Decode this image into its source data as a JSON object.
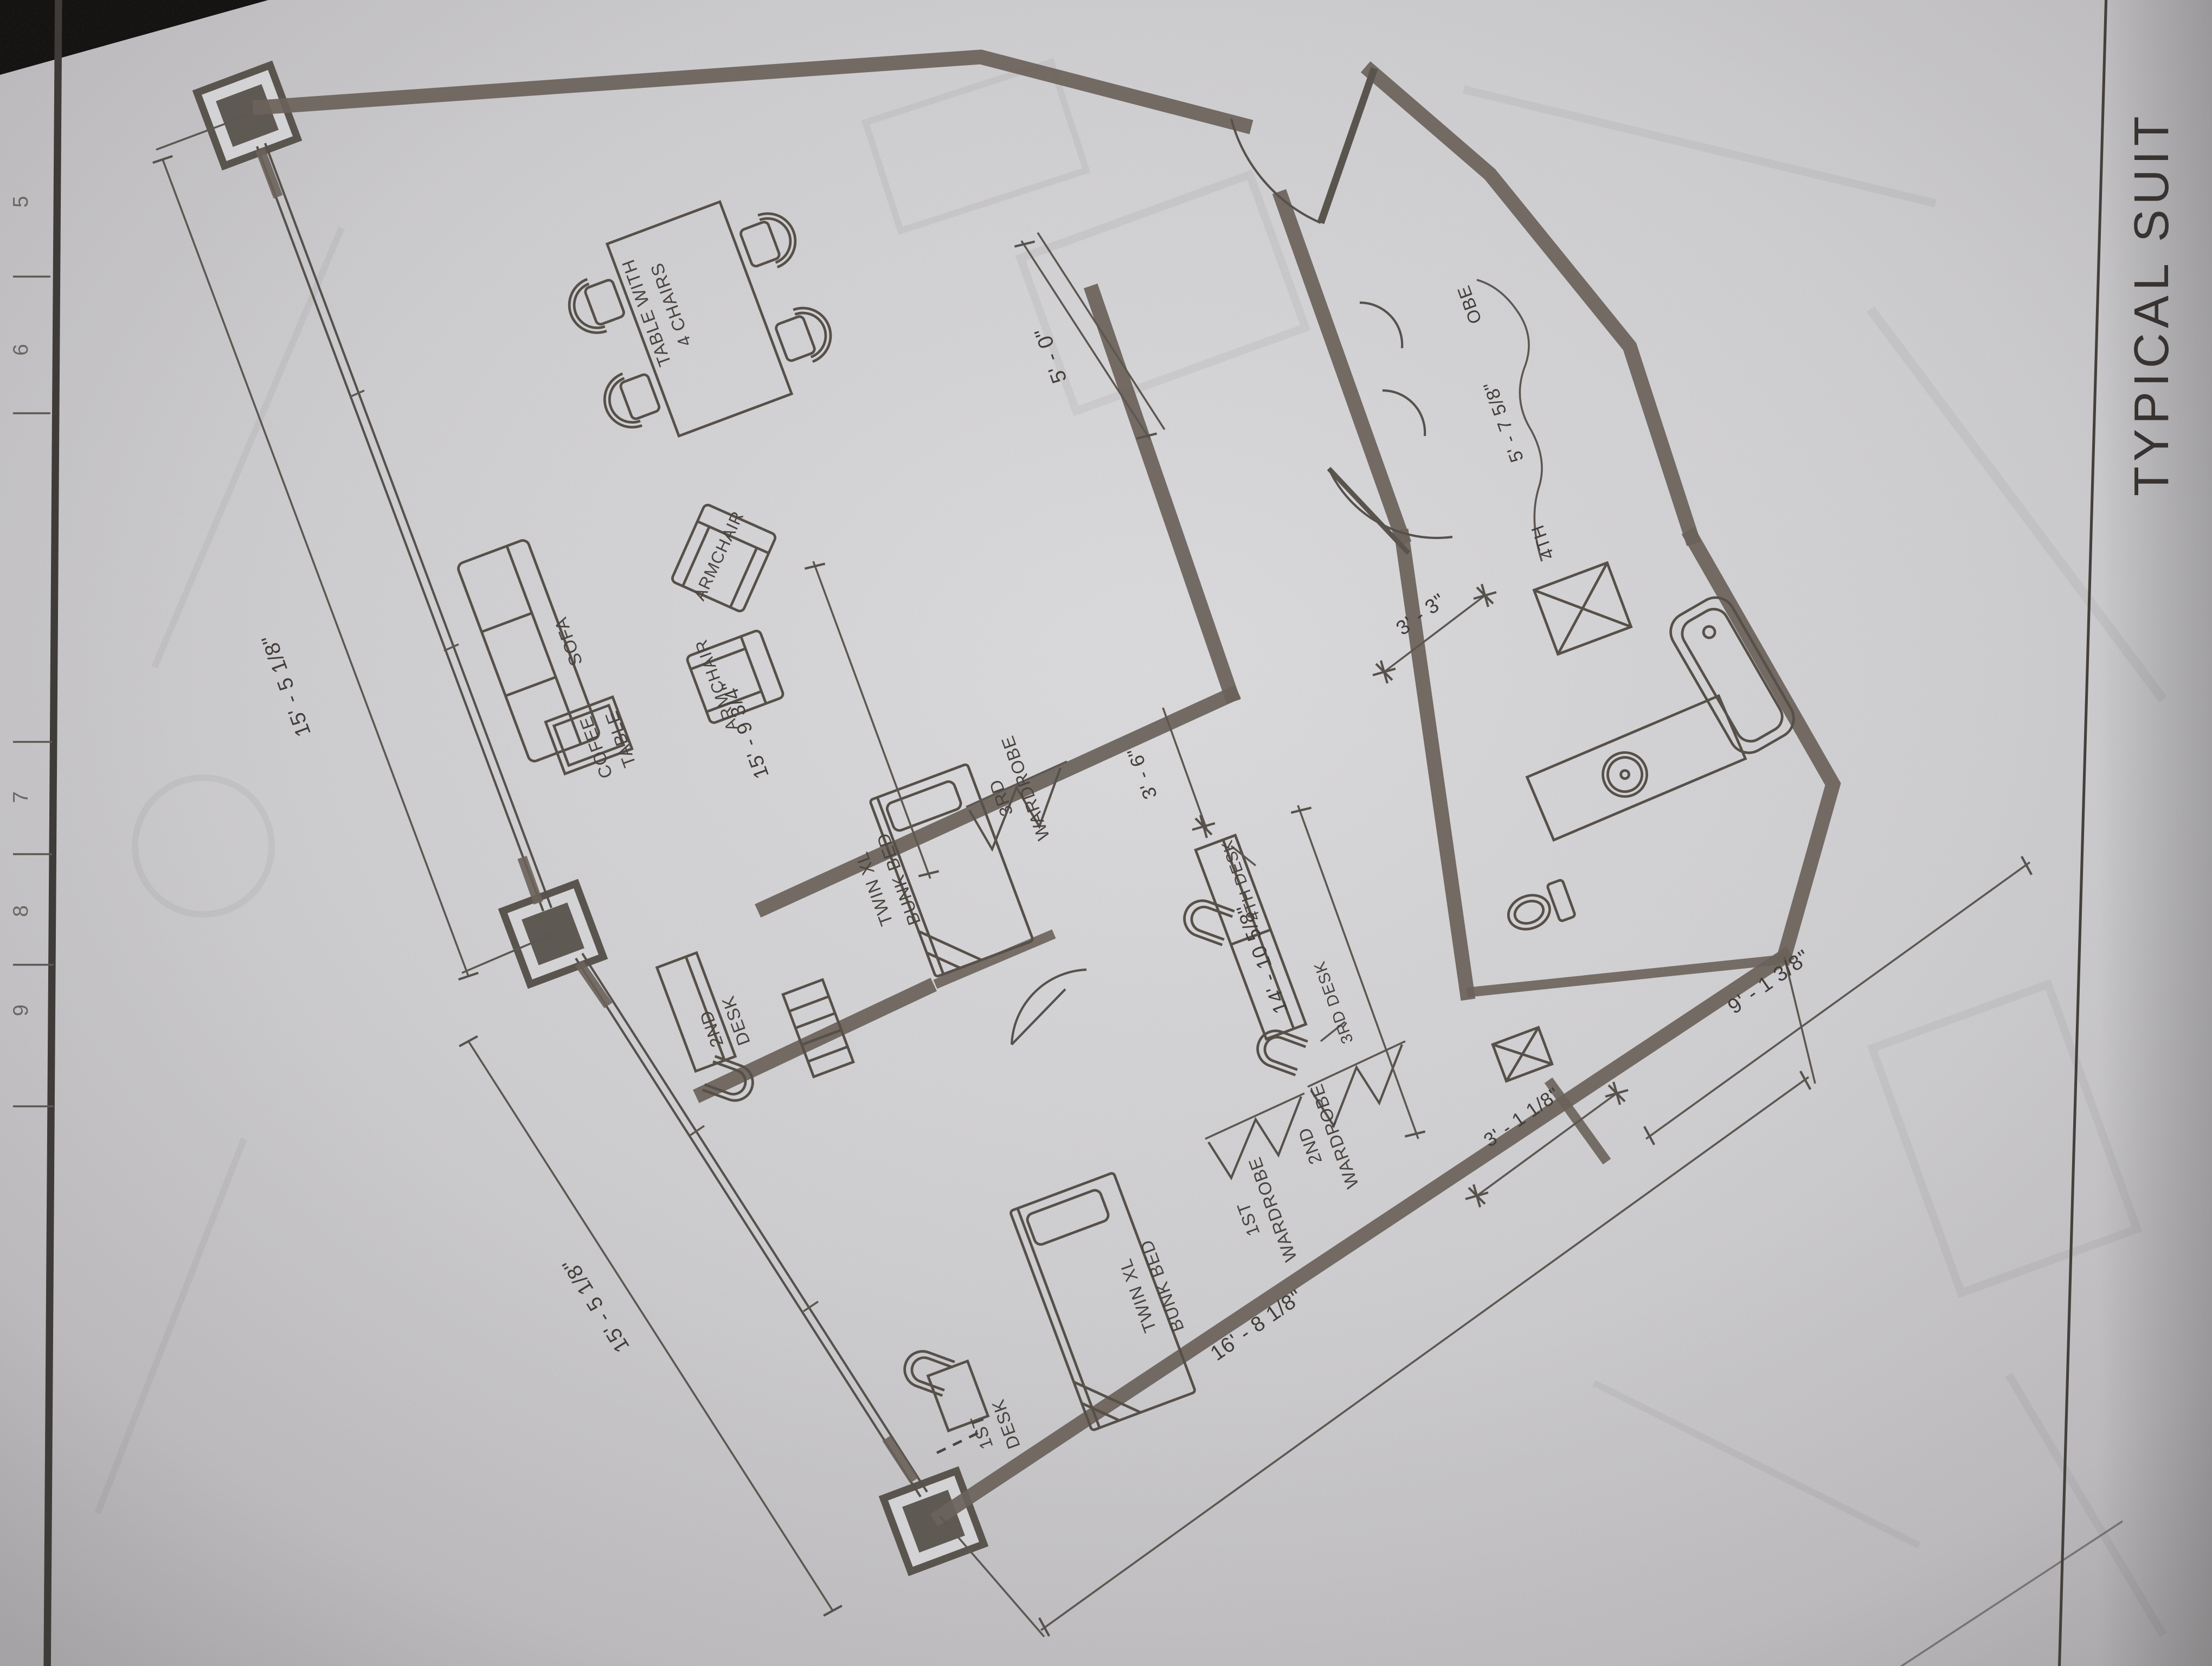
{
  "sheet": {
    "title": "TYPICAL SUIT",
    "grid_labels": [
      "5",
      "6",
      "7",
      "8",
      "9"
    ]
  },
  "exterior_dims": {
    "window_wall_a": "15' - 5 1/8\"",
    "window_wall_b": "15' - 5 1/8\"",
    "back_wall": "16' - 8 1/8\"",
    "bath_side": "9' - 1 3/8\"",
    "bath_offset": "3' - 1 1/8\""
  },
  "living_room": {
    "table": [
      "TABLE WITH",
      "4 CHAIRS"
    ],
    "sofa": "SOFA",
    "coffee_table": [
      "COFEE",
      "TABLE"
    ],
    "armchair_center": "ARMCHAIR",
    "armchair_side": "ARMCHAIR",
    "width_dim": "15' - 9 3/4\""
  },
  "bedroom1": {
    "bed": [
      "TWIN XL",
      "BUNK BED"
    ],
    "wardrobe": [
      "3RD",
      "WARDROBE"
    ],
    "desk": [
      "2ND",
      "DESK"
    ]
  },
  "bedroom2": {
    "bed": [
      "TWIN XL",
      "BUNK BED"
    ],
    "wardrobe1": [
      "1ST",
      "WARDROBE"
    ],
    "wardrobe2": [
      "2ND",
      "WARDROBE"
    ],
    "desk": [
      "1ST",
      "DESK"
    ]
  },
  "corridor": {
    "desk3": "3RD DESK",
    "desk4": "4TH DESK",
    "width_dim": "14' - 10 5/8\"",
    "nook_dim": "3' - 6\""
  },
  "entry": {
    "width_dim": "5' - 0\""
  },
  "closet": {
    "fragment_top": "OBE",
    "dim": "5' - 7 5/8\"",
    "fragment_bottom": "4TH"
  },
  "bath": {
    "niche_dim": "3' - 3\""
  }
}
